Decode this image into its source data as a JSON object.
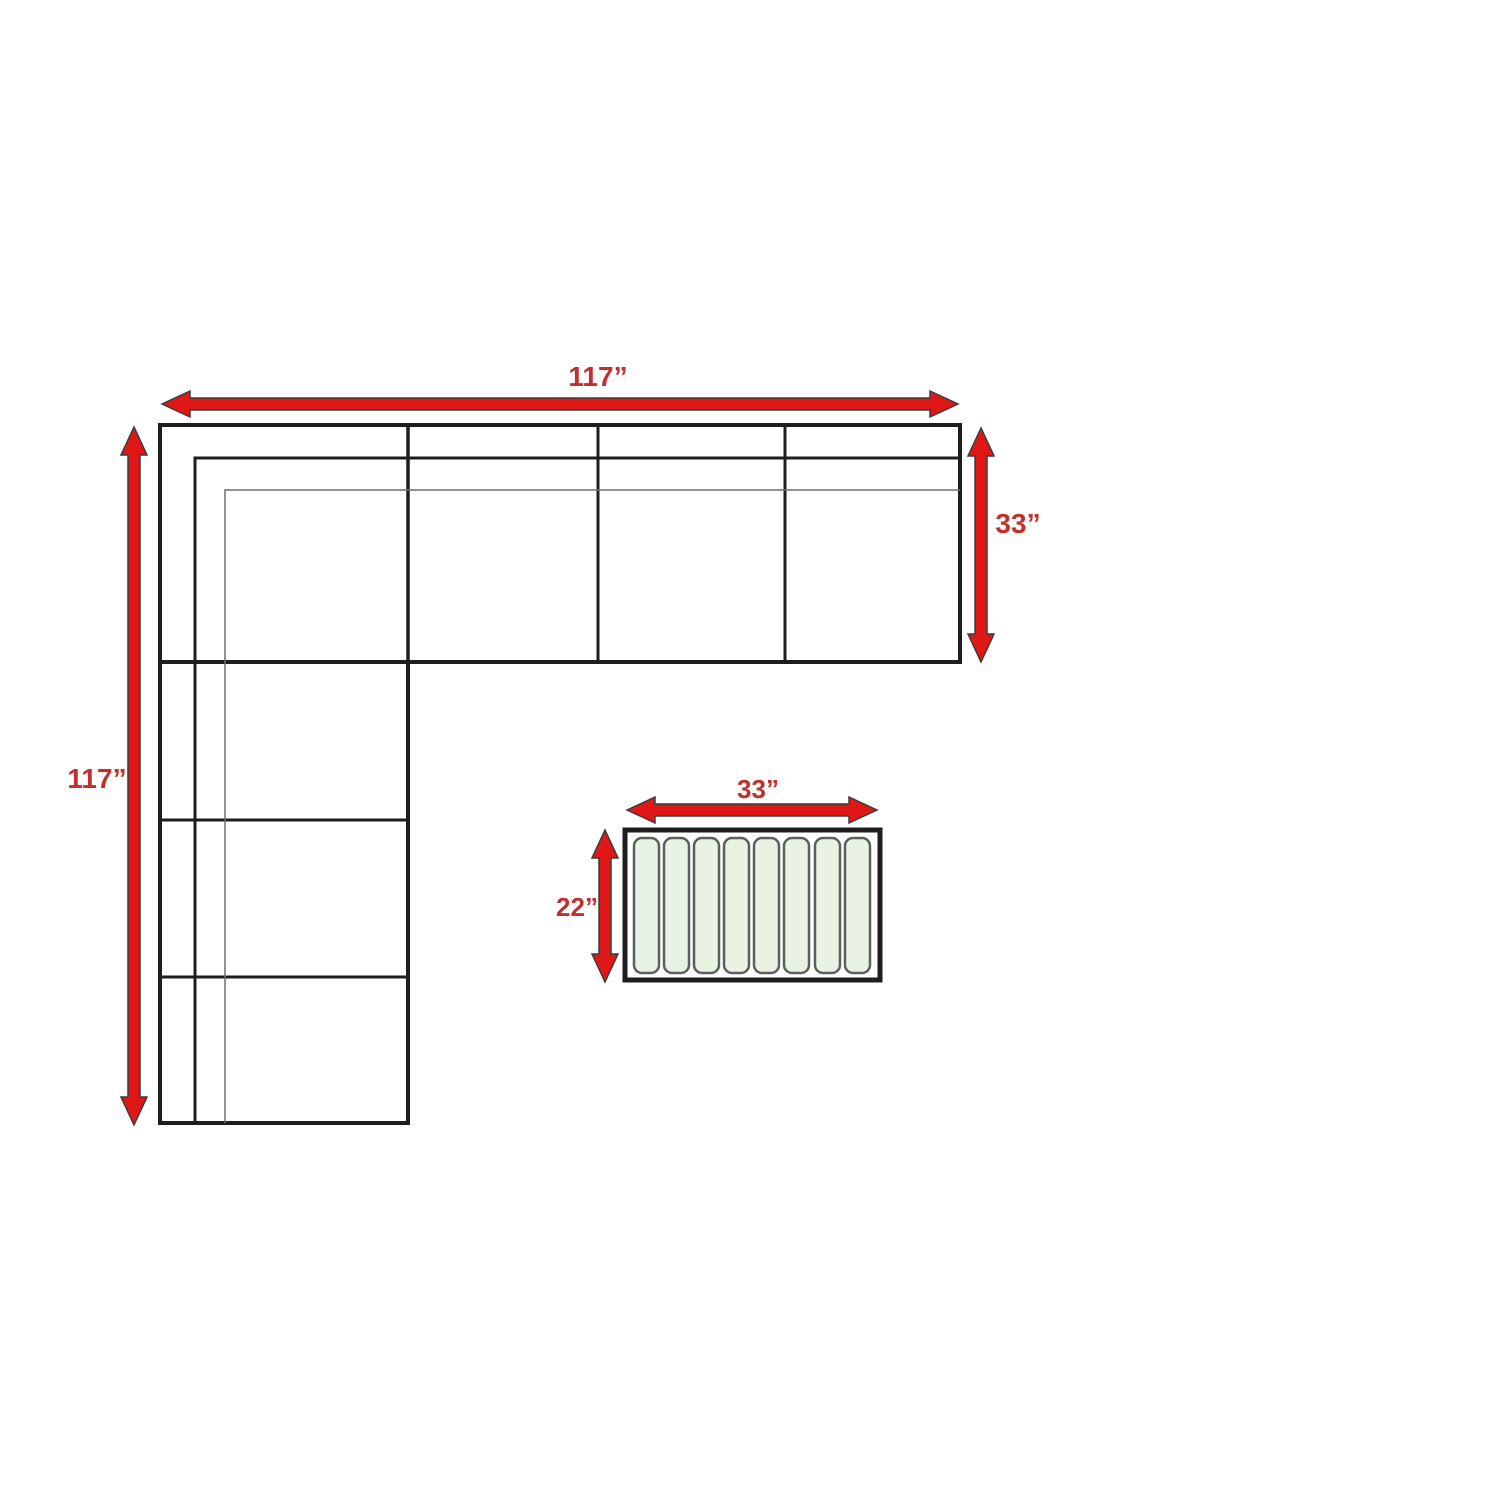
{
  "diagram_type": "furniture-dimension-diagram",
  "furniture": {
    "sofa": {
      "shape": "L-shaped sectional, top row of 4 sections and left column of 3 sections",
      "width_in": 117,
      "depth_in": 117,
      "section_depth_in": 33,
      "width_label": "117”",
      "depth_label": "117”",
      "section_depth_label": "33”"
    },
    "table": {
      "width_in": 33,
      "depth_in": 22,
      "width_label": "33”",
      "depth_label": "22”",
      "slat_count": 8
    }
  },
  "colors": {
    "background": "#ffffff",
    "outline": "#1e1e1e",
    "thin_line": "#6e6e6e",
    "arrow_red": "#e01717",
    "arrow_edge": "#3c3c3c",
    "label_red": "#c2302e",
    "slat_fill": "#e9f3e3",
    "slat_stroke": "#59615a"
  }
}
